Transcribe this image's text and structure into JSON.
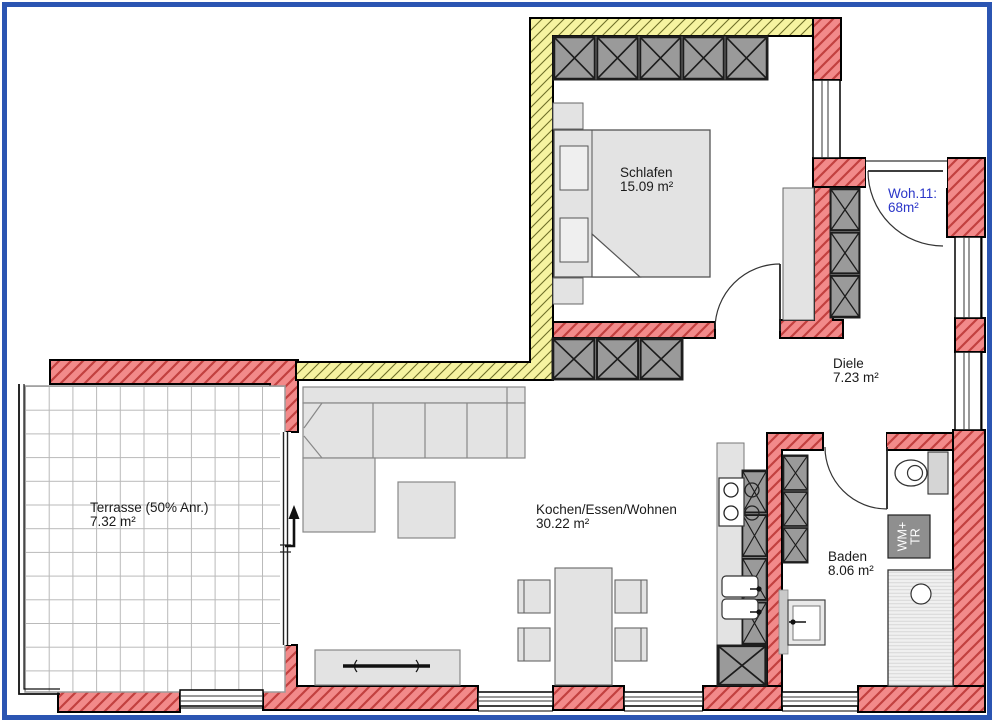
{
  "plan": {
    "unit": {
      "line1": "Woh.11:",
      "line2": "68m²"
    },
    "rooms": {
      "schlafen": {
        "name": "Schlafen",
        "area": "15.09 m²"
      },
      "diele": {
        "name": "Diele",
        "area": "7.23 m²"
      },
      "wohnen": {
        "name": "Kochen/Essen/Wohnen",
        "area": "30.22 m²"
      },
      "baden": {
        "name": "Baden",
        "area": "8.06 m²"
      },
      "terrasse": {
        "name": "Terrasse (50% Anr.)",
        "area": "7.32 m²"
      }
    },
    "appliances": {
      "washer_dryer": {
        "line1": "WM+",
        "line2": "TR"
      }
    },
    "colors": {
      "frame_blue": "#2b55b2",
      "wall_red": "#f28a8a",
      "wall_red_hatch": "#c2403f",
      "wall_yellow": "#f6f3a0",
      "wall_yellow_hatch": "#6e6e28",
      "cabinet_gray": "#9a9a9a",
      "furniture_gray": "#e3e3e3",
      "label_blue": "#2a35c8"
    }
  }
}
